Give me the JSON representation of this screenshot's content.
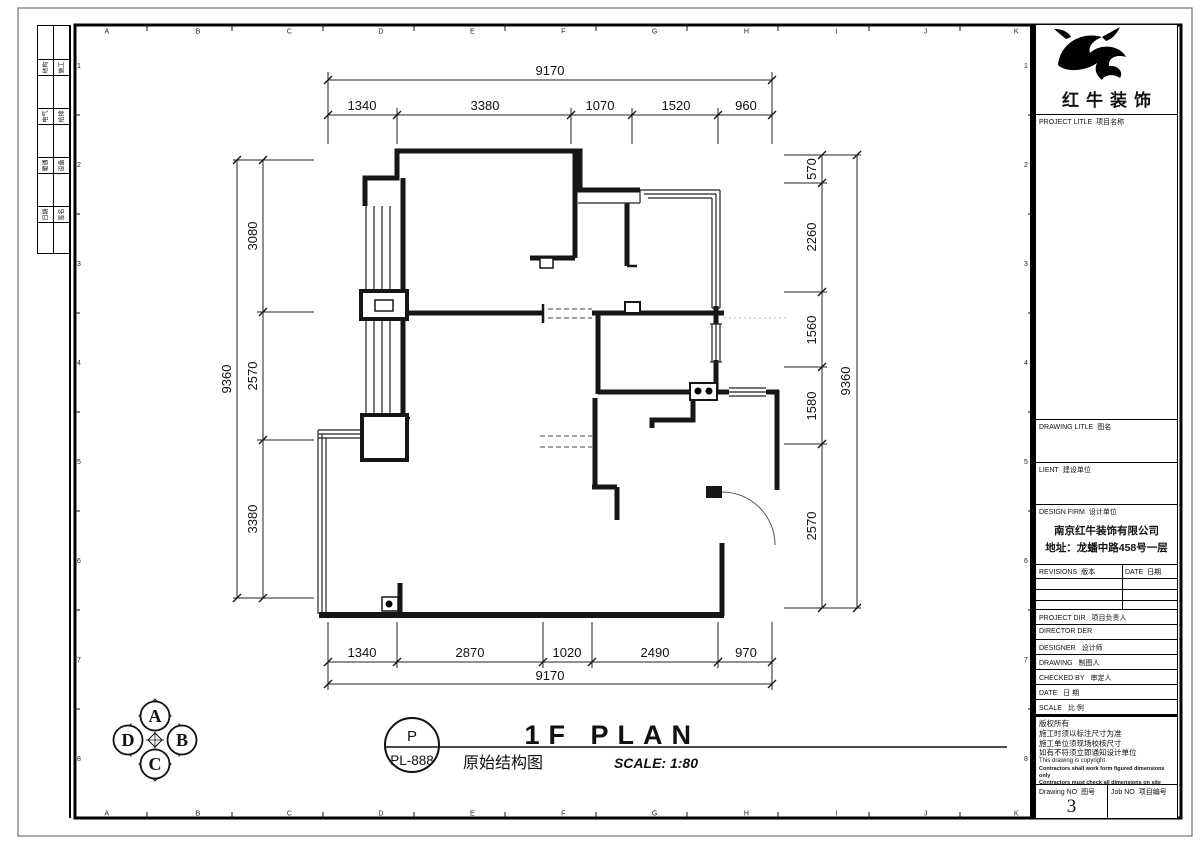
{
  "sheet": {
    "top_letters": "ABCDEFGHIJK",
    "side_numbers": [
      "1",
      "2",
      "3",
      "4",
      "5",
      "6",
      "7",
      "8"
    ]
  },
  "signature_strip": {
    "rows": [
      [
        "结构",
        "施工"
      ],
      [
        "电气",
        "给排"
      ],
      [
        "暖通",
        "设备"
      ],
      [
        "日期",
        "签名"
      ]
    ]
  },
  "title_block": {
    "brand": "红牛装饰",
    "project_label": "PROJECT LITLE",
    "project_cn": "项目名称",
    "drawing_label": "DRAWING LITLE",
    "drawing_cn": "图名",
    "client_label": "LIENT",
    "client_cn": "建设单位",
    "firm_label": "DESIGN FIRM",
    "firm_cn": "设计单位",
    "firm_name": "南京红牛装饰有限公司",
    "firm_address": "地址：龙蟠中路458号一层",
    "revisions_label": "REVISIONS",
    "revisions_cn": "版本",
    "date_label": "DATE",
    "date_cn": "日期",
    "rows": [
      {
        "en": "PROJECT DIR",
        "cn": "项目负责人"
      },
      {
        "en": "DIRECTOR DER",
        "cn": ""
      },
      {
        "en": "DESIGNER",
        "cn": "设计师"
      },
      {
        "en": "DRAWING",
        "cn": "制图人"
      },
      {
        "en": "CHECKED BY",
        "cn": "审定人"
      },
      {
        "en": "DATE",
        "cn": "日  期"
      },
      {
        "en": "SCALE",
        "cn": "比  例"
      }
    ],
    "copyright_cn": [
      "版权所有",
      "施工时须以标注尺寸为准",
      "施工单位须现场校核尺寸",
      "如有不符须立即通知设计单位"
    ],
    "copyright_en": [
      "This drawing is copyright",
      "Contractors shall work form figured dimensions only",
      "Contractors must check all dimensions on site",
      "Contractors must to reported immediately to architects"
    ],
    "drawing_no_label": "Drawing NO",
    "drawing_no_cn": "图号",
    "drawing_no": "3",
    "job_no_label": "Job NO",
    "job_no_cn": "项目编号"
  },
  "plan": {
    "dims_top": {
      "total": "9170",
      "segs": [
        "1340",
        "3380",
        "1070",
        "1520",
        "960"
      ]
    },
    "dims_bottom": {
      "total": "9170",
      "segs": [
        "1340",
        "2870",
        "1020",
        "2490",
        "970"
      ]
    },
    "dims_left": {
      "total": "9360",
      "segs": [
        "3080",
        "2570",
        "3380"
      ]
    },
    "dims_right": {
      "total": "9360",
      "segs": [
        "570",
        "2260",
        "1560",
        "1580",
        "2570"
      ]
    }
  },
  "footer": {
    "marker_letter": "P",
    "marker_code": "PL-888",
    "title_cn": "原始结构图",
    "title_en": "1F PLAN",
    "scale": "SCALE: 1:80",
    "compass": {
      "top": "A",
      "right": "B",
      "bottom": "C",
      "left": "D"
    }
  }
}
